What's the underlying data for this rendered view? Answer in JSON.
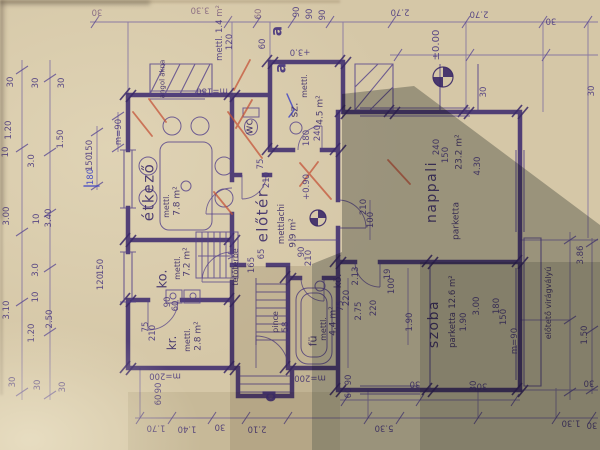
{
  "document": {
    "kind_label": "floor plan photo",
    "language": "hu"
  },
  "colors": {
    "paper": "#d5c7a7",
    "paper_shadow": "#8e9184",
    "ink_wall": "#3f2c6e",
    "ink_thin": "#53408a",
    "red_pencil": "#c4543a",
    "blue_pen": "#4348c4"
  },
  "rooms": {
    "etkezo": {
      "label": "étkező",
      "finish": "mettl.",
      "area": "7.8 m²"
    },
    "wc": {
      "label": "wc"
    },
    "sz": {
      "label": "sz.",
      "finish": "mettl.",
      "area": "4.5 m²"
    },
    "eloter": {
      "label": "előtér",
      "finish": "mettlachi",
      "area": "9.9 m²"
    },
    "nappali": {
      "label": "nappali",
      "finish": "parketta",
      "area": "23.2 m²"
    },
    "ko": {
      "label": "ko.",
      "finish": "mettl.",
      "area": "7.2 m²"
    },
    "kr": {
      "label": "kr.",
      "finish": "mettl.",
      "area": "2.8 m²"
    },
    "fu": {
      "label": "fü",
      "finish": "mettl.",
      "area": "4.4 m²"
    },
    "ko2": {
      "label": "kö."
    },
    "szoba": {
      "label": "szoba",
      "finish": "parketta",
      "area": "12.6 m²"
    },
    "pince": {
      "label": "pince"
    },
    "tetoterbe": {
      "label": "tetőtérbe"
    },
    "angol_akna": {
      "label": "angol akna"
    },
    "eloteto": {
      "label": "előtető virágvályú"
    }
  },
  "annotations": [
    {
      "t": "30",
      "x": 97,
      "y": 11,
      "r": 180
    },
    {
      "t": "3.30",
      "x": 200,
      "y": 9,
      "r": 180
    },
    {
      "t": "2.70",
      "x": 400,
      "y": 11,
      "r": 180
    },
    {
      "t": "2.70",
      "x": 479,
      "y": 13,
      "r": 180
    },
    {
      "t": "30",
      "x": 551,
      "y": 20,
      "r": 180
    },
    {
      "t": "m=180",
      "x": 212,
      "y": 90,
      "r": 180
    },
    {
      "t": "+3.0",
      "x": 300,
      "y": 51,
      "r": 180
    },
    {
      "t": "mettl. 1.4 m²",
      "x": 220,
      "y": 33
    },
    {
      "t": "120",
      "x": 230,
      "y": 42
    },
    {
      "t": "60",
      "x": 259,
      "y": 14
    },
    {
      "t": "60",
      "x": 263,
      "y": 44
    },
    {
      "t": "90",
      "x": 297,
      "y": 12
    },
    {
      "t": "90",
      "x": 310,
      "y": 14
    },
    {
      "t": "90",
      "x": 323,
      "y": 15
    },
    {
      "t": "±0.00",
      "x": 437,
      "y": 45,
      "s": 10,
      "n": "level-marker-zero"
    },
    {
      "t": "30",
      "x": 484,
      "y": 92
    },
    {
      "t": "30",
      "x": 592,
      "y": 91
    },
    {
      "t": "30",
      "x": 11,
      "y": 82
    },
    {
      "t": "30",
      "x": 36,
      "y": 83
    },
    {
      "t": "30",
      "x": 62,
      "y": 83
    },
    {
      "t": "1.20",
      "x": 9,
      "y": 130
    },
    {
      "t": "10",
      "x": 6,
      "y": 152
    },
    {
      "t": "3.0",
      "x": 32,
      "y": 161
    },
    {
      "t": "1.50",
      "x": 61,
      "y": 139
    },
    {
      "t": "150",
      "x": 90,
      "y": 148
    },
    {
      "t": "150",
      "x": 90,
      "y": 163
    },
    {
      "t": "m=90",
      "x": 119,
      "y": 132
    },
    {
      "t": "180",
      "x": 91,
      "y": 177,
      "c": "blue",
      "n": "handwritten-correction"
    },
    {
      "t": "3.00",
      "x": 7,
      "y": 216
    },
    {
      "t": "10",
      "x": 37,
      "y": 219
    },
    {
      "t": "3.40",
      "x": 49,
      "y": 218
    },
    {
      "t": "3.0",
      "x": 36,
      "y": 270
    },
    {
      "t": "150",
      "x": 101,
      "y": 267
    },
    {
      "t": "120",
      "x": 101,
      "y": 282
    },
    {
      "t": "3.10",
      "x": 7,
      "y": 310
    },
    {
      "t": "10",
      "x": 36,
      "y": 297
    },
    {
      "t": "2.50",
      "x": 50,
      "y": 319
    },
    {
      "t": "1.20",
      "x": 32,
      "y": 333
    },
    {
      "t": "30",
      "x": 13,
      "y": 382
    },
    {
      "t": "30",
      "x": 38,
      "y": 385
    },
    {
      "t": "30",
      "x": 63,
      "y": 387
    },
    {
      "t": "90",
      "x": 168,
      "y": 302
    },
    {
      "t": "60",
      "x": 176,
      "y": 306
    },
    {
      "t": "75",
      "x": 146,
      "y": 327
    },
    {
      "t": "210",
      "x": 153,
      "y": 333
    },
    {
      "t": "m=200",
      "x": 165,
      "y": 375,
      "r": 180
    },
    {
      "t": "90",
      "x": 159,
      "y": 388
    },
    {
      "t": "60",
      "x": 159,
      "y": 400
    },
    {
      "t": "75",
      "x": 261,
      "y": 164
    },
    {
      "t": "210",
      "x": 267,
      "y": 180
    },
    {
      "t": "65",
      "x": 262,
      "y": 254
    },
    {
      "t": "90",
      "x": 302,
      "y": 252
    },
    {
      "t": "210",
      "x": 309,
      "y": 258
    },
    {
      "t": "165",
      "x": 252,
      "y": 265
    },
    {
      "t": "58",
      "x": 286,
      "y": 327
    },
    {
      "t": "180",
      "x": 307,
      "y": 138
    },
    {
      "t": "240",
      "x": 318,
      "y": 133
    },
    {
      "t": "+0.90",
      "x": 307,
      "y": 187,
      "n": "level-marker-plus-090"
    },
    {
      "t": "210",
      "x": 364,
      "y": 207
    },
    {
      "t": "100",
      "x": 371,
      "y": 220
    },
    {
      "t": "240",
      "x": 437,
      "y": 147
    },
    {
      "t": "150",
      "x": 446,
      "y": 155
    },
    {
      "t": "4.30",
      "x": 478,
      "y": 166
    },
    {
      "t": "2.13",
      "x": 356,
      "y": 276
    },
    {
      "t": "2.75",
      "x": 359,
      "y": 311
    },
    {
      "t": "220",
      "x": 374,
      "y": 308
    },
    {
      "t": "1.90",
      "x": 410,
      "y": 322
    },
    {
      "t": "1.90",
      "x": 464,
      "y": 322
    },
    {
      "t": "19",
      "x": 388,
      "y": 274
    },
    {
      "t": "100",
      "x": 392,
      "y": 286
    },
    {
      "t": "75",
      "x": 341,
      "y": 306
    },
    {
      "t": "220",
      "x": 347,
      "y": 298
    },
    {
      "t": "3.00",
      "x": 477,
      "y": 306
    },
    {
      "t": "180",
      "x": 497,
      "y": 306
    },
    {
      "t": "150",
      "x": 504,
      "y": 317
    },
    {
      "t": "m=90",
      "x": 515,
      "y": 341
    },
    {
      "t": "3.86",
      "x": 581,
      "y": 255
    },
    {
      "t": "1.50",
      "x": 585,
      "y": 335
    },
    {
      "t": "30",
      "x": 474,
      "y": 386
    },
    {
      "t": "90",
      "x": 349,
      "y": 380
    },
    {
      "t": "60",
      "x": 349,
      "y": 393
    },
    {
      "t": "m=200",
      "x": 310,
      "y": 377,
      "r": 180
    },
    {
      "t": "1.70",
      "x": 156,
      "y": 427,
      "r": 180
    },
    {
      "t": "1.40",
      "x": 187,
      "y": 428,
      "r": 180
    },
    {
      "t": "30",
      "x": 220,
      "y": 426,
      "r": 180
    },
    {
      "t": "2.10",
      "x": 257,
      "y": 428,
      "r": 180
    },
    {
      "t": "5.30",
      "x": 384,
      "y": 427,
      "r": 180
    },
    {
      "t": "1.30",
      "x": 571,
      "y": 422,
      "r": 180
    },
    {
      "t": "30",
      "x": 592,
      "y": 424,
      "r": 180
    },
    {
      "t": "30",
      "x": 415,
      "y": 383,
      "r": 180
    },
    {
      "t": "30",
      "x": 482,
      "y": 385,
      "r": 180
    },
    {
      "t": "30",
      "x": 589,
      "y": 382,
      "r": 180
    },
    {
      "t": "a",
      "x": 277,
      "y": 31,
      "s": 15,
      "c": "big",
      "n": "section-letter-a"
    },
    {
      "t": "a",
      "x": 281,
      "y": 68,
      "s": 15,
      "c": "big",
      "n": "section-letter-a"
    },
    {
      "t": "d",
      "x": 271,
      "y": 396,
      "s": 17,
      "c": "big",
      "n": "section-letter-d"
    }
  ]
}
